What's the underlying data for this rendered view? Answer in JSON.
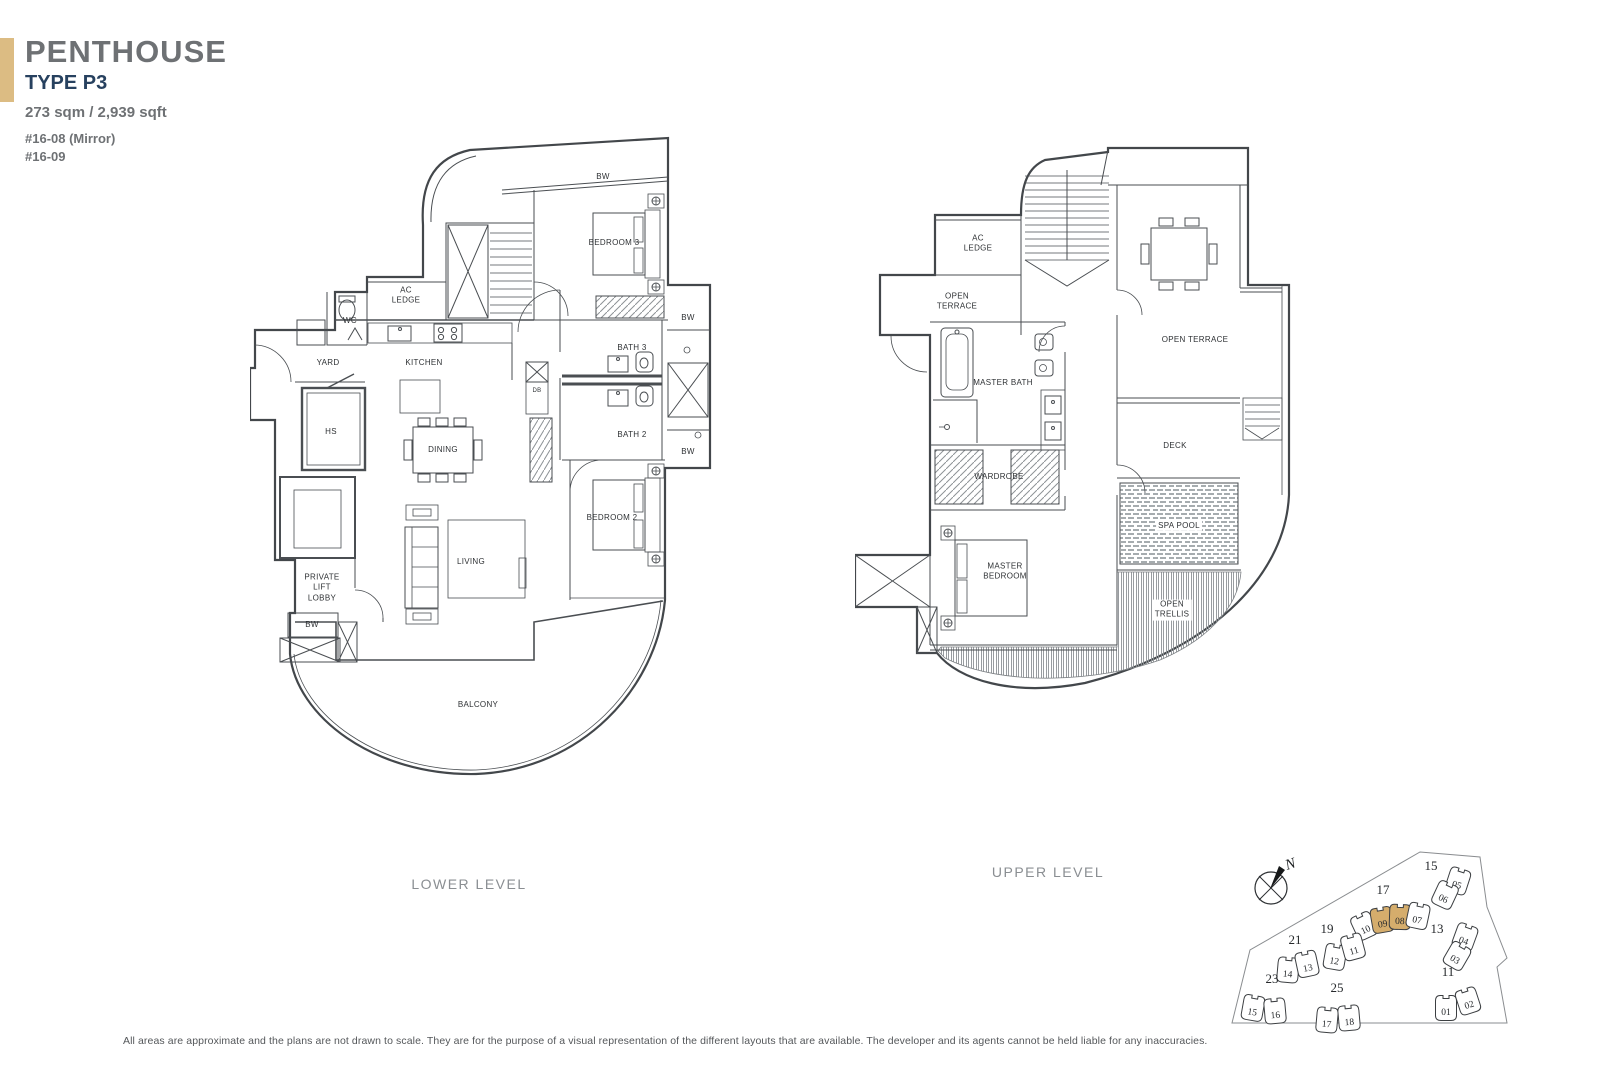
{
  "header": {
    "title": "PENTHOUSE",
    "type": "TYPE P3",
    "area": "273 sqm / 2,939 sqft",
    "unit_line1": "#16-08 (Mirror)",
    "unit_line2": "#16-09",
    "accent_color": "#dcbc83",
    "type_color": "#27415f"
  },
  "plans": {
    "lower": {
      "name": "LOWER LEVEL",
      "labels": [
        {
          "lines": [
            "BW"
          ],
          "x": 353,
          "y": 47
        },
        {
          "lines": [
            "BEDROOM 3"
          ],
          "x": 364,
          "y": 113
        },
        {
          "lines": [
            "AC",
            "LEDGE"
          ],
          "x": 156,
          "y": 166
        },
        {
          "lines": [
            "WC"
          ],
          "x": 100,
          "y": 191
        },
        {
          "lines": [
            "YARD"
          ],
          "x": 78,
          "y": 233
        },
        {
          "lines": [
            "KITCHEN"
          ],
          "x": 174,
          "y": 233
        },
        {
          "lines": [
            "HS"
          ],
          "x": 81,
          "y": 302
        },
        {
          "lines": [
            "DINING"
          ],
          "x": 193,
          "y": 320
        },
        {
          "lines": [
            "DB"
          ],
          "x": 287,
          "y": 262,
          "size": 6
        },
        {
          "lines": [
            "BATH 3"
          ],
          "x": 382,
          "y": 218
        },
        {
          "lines": [
            "BATH 2"
          ],
          "x": 382,
          "y": 305
        },
        {
          "lines": [
            "BW"
          ],
          "x": 438,
          "y": 188
        },
        {
          "lines": [
            "BW"
          ],
          "x": 438,
          "y": 322
        },
        {
          "lines": [
            "BEDROOM 2"
          ],
          "x": 362,
          "y": 388
        },
        {
          "lines": [
            "LIVING"
          ],
          "x": 221,
          "y": 432
        },
        {
          "lines": [
            "PRIVATE",
            "LIFT",
            "LOBBY"
          ],
          "x": 72,
          "y": 458
        },
        {
          "lines": [
            "BW"
          ],
          "x": 62,
          "y": 495
        },
        {
          "lines": [
            "BALCONY"
          ],
          "x": 228,
          "y": 575
        }
      ]
    },
    "upper": {
      "name": "UPPER LEVEL",
      "labels": [
        {
          "lines": [
            "AC",
            "LEDGE"
          ],
          "x": 123,
          "y": 104
        },
        {
          "lines": [
            "OPEN",
            "TERRACE"
          ],
          "x": 102,
          "y": 162
        },
        {
          "lines": [
            "MASTER BATH"
          ],
          "x": 148,
          "y": 243
        },
        {
          "lines": [
            "OPEN TERRACE"
          ],
          "x": 340,
          "y": 200
        },
        {
          "lines": [
            "DECK"
          ],
          "x": 320,
          "y": 306
        },
        {
          "lines": [
            "SPA POOL"
          ],
          "x": 324,
          "y": 386,
          "bg": true
        },
        {
          "lines": [
            "WARDROBE"
          ],
          "x": 144,
          "y": 337
        },
        {
          "lines": [
            "MASTER",
            "BEDROOM"
          ],
          "x": 150,
          "y": 432
        },
        {
          "lines": [
            "OPEN",
            "TRELLIS"
          ],
          "x": 317,
          "y": 470,
          "bg": true
        }
      ]
    }
  },
  "site_plan": {
    "compass_label": "N",
    "highlight_color": "#d5ad6c",
    "blocks": [
      {
        "label": "15",
        "x": 216,
        "y": 40,
        "units": [
          {
            "no": "05",
            "x": 243,
            "y": 51,
            "rot": 18,
            "highlight": false
          },
          {
            "no": "06",
            "x": 230,
            "y": 65,
            "rot": 25,
            "highlight": false
          }
        ]
      },
      {
        "label": "17",
        "x": 168,
        "y": 64,
        "units": [
          {
            "no": "10",
            "x": 149,
            "y": 96,
            "rot": -25,
            "highlight": false
          },
          {
            "no": "09",
            "x": 167,
            "y": 90,
            "rot": -10,
            "highlight": true
          },
          {
            "no": "08",
            "x": 185,
            "y": 87,
            "rot": 2,
            "highlight": true
          },
          {
            "no": "07",
            "x": 203,
            "y": 86,
            "rot": 12,
            "highlight": false
          }
        ]
      },
      {
        "label": "13",
        "x": 222,
        "y": 103,
        "units": [
          {
            "no": "04",
            "x": 250,
            "y": 107,
            "rot": 20,
            "highlight": false
          },
          {
            "no": "03",
            "x": 242,
            "y": 126,
            "rot": 30,
            "highlight": false
          }
        ]
      },
      {
        "label": "19",
        "x": 112,
        "y": 103,
        "units": [
          {
            "no": "12",
            "x": 120,
            "y": 127,
            "rot": 10,
            "highlight": false
          },
          {
            "no": "11",
            "x": 138,
            "y": 117,
            "rot": -15,
            "highlight": false
          }
        ]
      },
      {
        "label": "21",
        "x": 80,
        "y": 114,
        "units": [
          {
            "no": "14",
            "x": 73,
            "y": 140,
            "rot": 5,
            "highlight": false
          },
          {
            "no": "13",
            "x": 92,
            "y": 134,
            "rot": -12,
            "highlight": false
          }
        ]
      },
      {
        "label": "11",
        "x": 233,
        "y": 146,
        "units": [
          {
            "no": "01",
            "x": 231,
            "y": 178,
            "rot": 0,
            "highlight": false
          },
          {
            "no": "02",
            "x": 253,
            "y": 171,
            "rot": -18,
            "highlight": false
          }
        ]
      },
      {
        "label": "23",
        "x": 57,
        "y": 153,
        "units": [
          {
            "no": "15",
            "x": 38,
            "y": 178,
            "rot": 10,
            "highlight": false
          },
          {
            "no": "16",
            "x": 60,
            "y": 181,
            "rot": -5,
            "highlight": false
          }
        ]
      },
      {
        "label": "25",
        "x": 122,
        "y": 162,
        "units": [
          {
            "no": "17",
            "x": 112,
            "y": 190,
            "rot": 5,
            "highlight": false
          },
          {
            "no": "18",
            "x": 134,
            "y": 188,
            "rot": -5,
            "highlight": false
          }
        ]
      }
    ]
  },
  "footer": {
    "disclaimer": "All areas are approximate and the plans are not drawn to scale. They are for the purpose of a visual representation of the different layouts that are available. The developer and its agents cannot be held liable for any inaccuracies."
  }
}
